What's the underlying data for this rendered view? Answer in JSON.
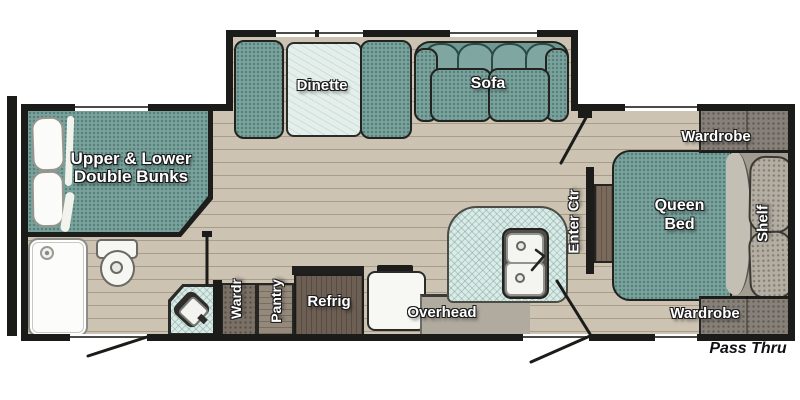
{
  "diagram": {
    "type": "travel-trailer-floor-plan",
    "labels": {
      "bunks_line1": "Upper & Lower",
      "bunks_line2": "Double Bunks",
      "dinette": "Dinette",
      "sofa": "Sofa",
      "wardrobe_top": "Wardrobe",
      "queen_bed_line1": "Queen",
      "queen_bed_line2": "Bed",
      "shelf": "Shelf",
      "entertainment_center": "Enter Ctr",
      "wardrobe_small": "Wardr",
      "pantry": "Pantry",
      "refrigerator": "Refrig",
      "overhead": "Overhead",
      "wardrobe_bottom": "Wardrobe",
      "pass_thru": "Pass Thru"
    },
    "fixtures": [
      "shower",
      "toilet",
      "corner-bath-sink",
      "double-kitchen-sink",
      "three-burner-stove",
      "dinette-table",
      "bunk-pillows",
      "queen-pillows",
      "entry-door-swings",
      "windows"
    ],
    "colors": {
      "wall": "#1b1b19",
      "floor": "#cdc3b3",
      "upholstery_teal": "#7aa29d",
      "table_top": "#e4efeb",
      "counter_blue": "#d9eae7",
      "cabinet_gray": "#b1aa9e",
      "wood_dark": "#6d5f53",
      "wood_medium": "#95897b",
      "wardrobe_gray": "#878078",
      "background": "#ffffff"
    }
  }
}
